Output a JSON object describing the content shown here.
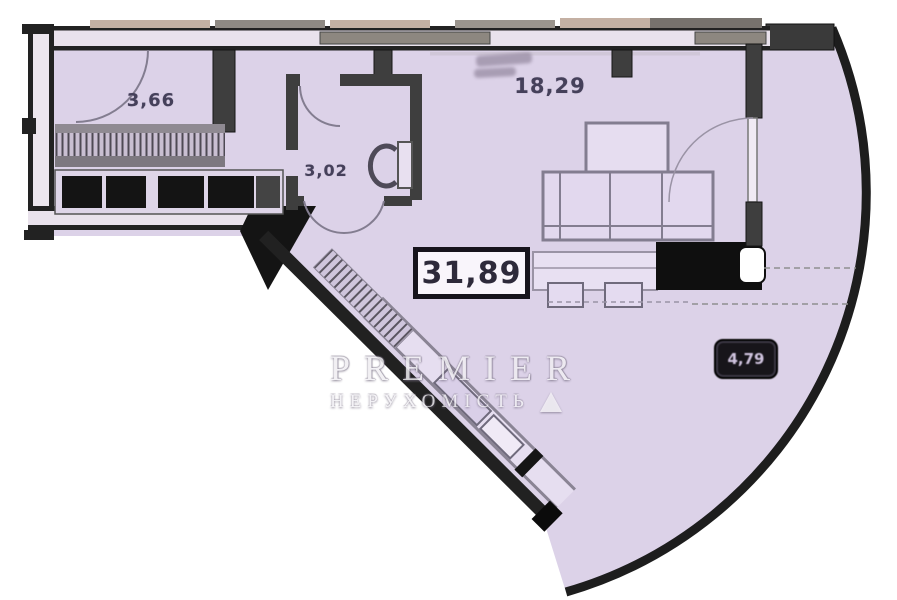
{
  "labels": {
    "hall_area": "3,66",
    "main_room_area": "18,29",
    "bathroom_area": "3,02",
    "total_area": "31,89",
    "balcony_area": "4,79"
  },
  "watermark": {
    "brand": "PREMIER",
    "subtitle": "НЕРУХОМІСТЬ"
  },
  "colors": {
    "outside": "#ffffff",
    "floor": "#dcd2e8",
    "wall_dark": "#1c1c1c",
    "wall_mid": "#3e3e3e",
    "wall_fill": "#ece6ee",
    "line_gray": "#837d90",
    "label_text": "#45405a",
    "badge_bg": "#17151a",
    "badge_text": "#cfc3de",
    "window_tan": "#c4b0a3",
    "window_gray": "#8d8780",
    "fixture_black": "#0f0f0f"
  }
}
